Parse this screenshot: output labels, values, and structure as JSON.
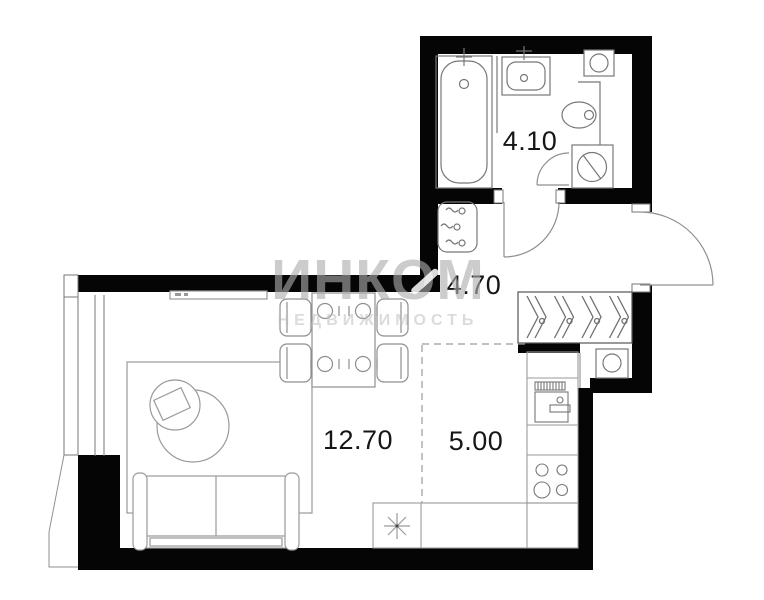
{
  "watermark": {
    "brand": "ИНКОМ",
    "subtitle": "НЕДВИЖИМОСТЬ"
  },
  "rooms": {
    "bathroom": {
      "area": "4.10"
    },
    "hallway": {
      "area": "4.70"
    },
    "living": {
      "area": "12.70"
    },
    "kitchen": {
      "area": "5.00"
    }
  },
  "icons": {
    "bathtub": "rounded-rect-tub",
    "washbasin": "rect-basin",
    "toilet": "ellipse-bowl",
    "washing-machine": "square-with-drum-circle",
    "vent-shaft": "square-with-circle",
    "appliance-unit": "rounded-rect-with-squiggles",
    "wardrobe-hanger": "double-chevron-hook",
    "entrance-door": "quarter-arc",
    "bathroom-door": "quarter-arc",
    "dining-table": "rect-with-plates",
    "chair": "rounded-rect",
    "sofa": "rect-with-armrests",
    "rug": "rect-outline",
    "coffee-table": "circle-with-square",
    "pouf": "circle",
    "tv-console": "thin-rect",
    "stove": "four-burner-circles",
    "kitchen-sink": "square-with-tap",
    "dish-rack": "hatched-rect",
    "sink-star": "eight-point-asterisk",
    "window": "double-line-strip"
  },
  "colors": {
    "background": "#ffffff",
    "wall": "#050505",
    "fixture_line": "#777777",
    "furniture_line": "#8f8f8f",
    "light_line": "#9a9a9a",
    "label": "#161616",
    "watermark": "#adadad"
  }
}
